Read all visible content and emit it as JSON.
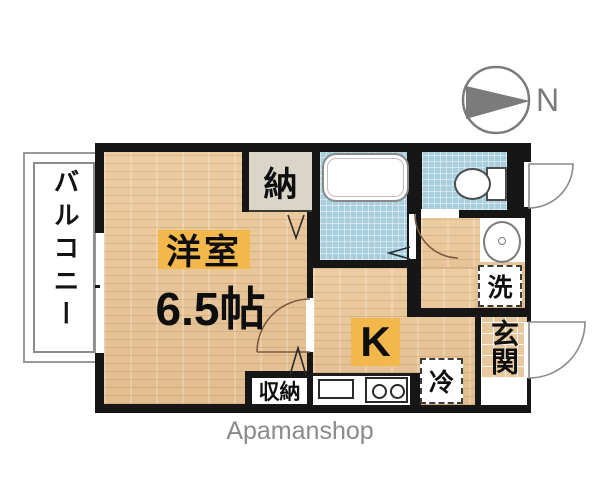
{
  "plan": {
    "watermark": "Apamanshop",
    "compass_label": "N",
    "balcony_label": "バルコニー",
    "rooms": {
      "main_name": "洋室",
      "main_size": "6.5帖",
      "storage": "納",
      "closet": "収納",
      "kitchen": "K",
      "entrance": "玄関"
    },
    "appliances": {
      "refrigerator": "冷",
      "washer": "洗"
    },
    "colors": {
      "wall": "#161616",
      "wood_floor": "#e7c59a",
      "wet_area_blue": "#a9cede",
      "label_highlight": "#f3b84b",
      "storage_gray": "#d9d6c8",
      "entrance_tile": "#e8c89e",
      "compass_gray": "#7b7b7b",
      "watermark_gray": "#8a8a8a"
    }
  }
}
